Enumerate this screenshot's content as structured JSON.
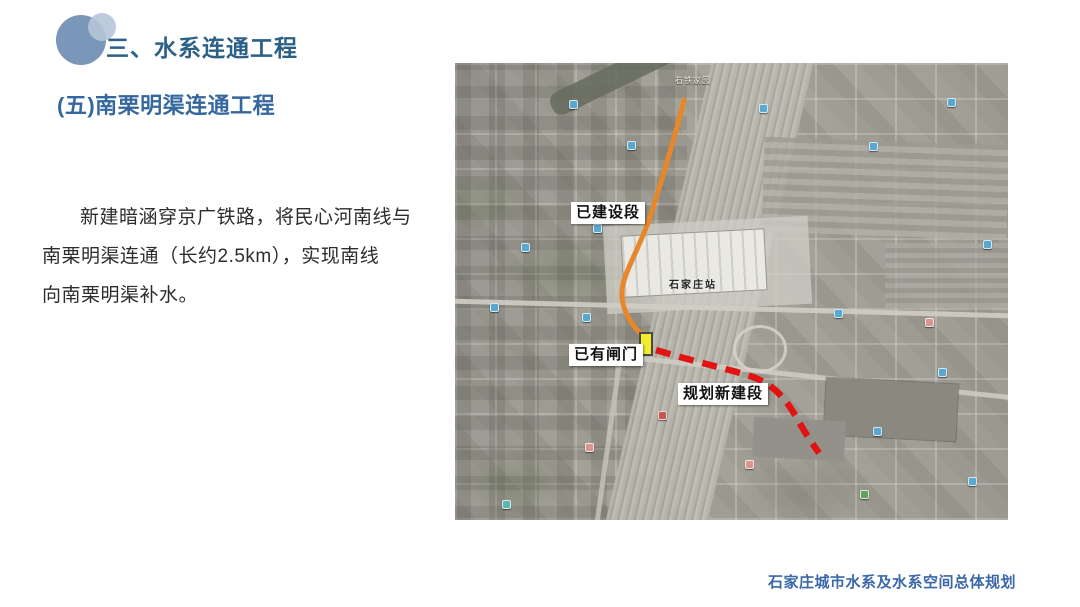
{
  "page": {
    "title": "三、水系连通工程",
    "subtitle": "(五)南栗明渠连通工程",
    "body_lines": [
      "新建暗涵穿京广铁路，将民心河南线与",
      "南栗明渠连通（长约2.5km），实现南线",
      "向南栗明渠补水。"
    ],
    "footer": "石家庄城市水系及水系空间总体规划"
  },
  "colors": {
    "title_text": "#2b6187",
    "subtitle_text": "#35679f",
    "footer_text": "#3a68a8",
    "built_line": "#e8872a",
    "planned_line": "#e21313",
    "gate_marker_fill": "#f2ee2e"
  },
  "map": {
    "annotations": {
      "built_section": "已建设段",
      "existing_gate": "已有闸门",
      "planned_section": "规划新建段",
      "station": "石家庄站",
      "poi_top": "石铁家园"
    },
    "legend_meaning": {
      "orange_line": "built canal section",
      "red_dashed_line": "planned new section",
      "yellow_rect": "existing gate"
    },
    "markers": [
      {
        "x": 114,
        "y": 37,
        "c": "blue"
      },
      {
        "x": 172,
        "y": 78,
        "c": "blue"
      },
      {
        "x": 138,
        "y": 161,
        "c": "blue"
      },
      {
        "x": 66,
        "y": 180,
        "c": "blue"
      },
      {
        "x": 35,
        "y": 240,
        "c": "blue"
      },
      {
        "x": 127,
        "y": 250,
        "c": "blue"
      },
      {
        "x": 304,
        "y": 41,
        "c": "blue"
      },
      {
        "x": 414,
        "y": 79,
        "c": "blue"
      },
      {
        "x": 492,
        "y": 35,
        "c": "blue"
      },
      {
        "x": 528,
        "y": 177,
        "c": "blue"
      },
      {
        "x": 379,
        "y": 246,
        "c": "blue"
      },
      {
        "x": 483,
        "y": 305,
        "c": "blue"
      },
      {
        "x": 418,
        "y": 364,
        "c": "blue"
      },
      {
        "x": 513,
        "y": 414,
        "c": "blue"
      },
      {
        "x": 203,
        "y": 348,
        "c": "red"
      },
      {
        "x": 405,
        "y": 427,
        "c": "green"
      },
      {
        "x": 47,
        "y": 437,
        "c": "teal"
      },
      {
        "x": 470,
        "y": 255,
        "c": "pink"
      },
      {
        "x": 130,
        "y": 380,
        "c": "pink"
      },
      {
        "x": 290,
        "y": 397,
        "c": "pink"
      }
    ]
  }
}
